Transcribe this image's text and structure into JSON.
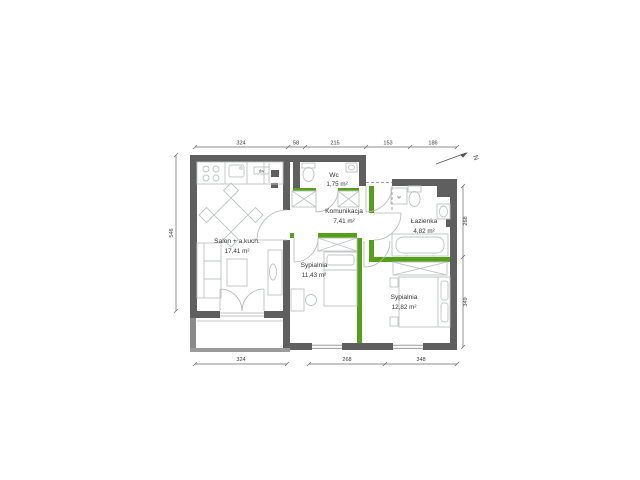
{
  "plan": {
    "north": {
      "label": "N"
    },
    "rooms": [
      {
        "name": "Salon + a.kuch.",
        "area": "17,41 m²"
      },
      {
        "name": "Komunikacja",
        "area": "7,41 m²"
      },
      {
        "name": "Wc",
        "area": "1,75 m²"
      },
      {
        "name": "Łazienka",
        "area": "4,82 m²"
      },
      {
        "name": "Sypialnia",
        "area": "11,43 m²"
      },
      {
        "name": "Sypialnia",
        "area": "12,82 m²"
      }
    ],
    "dimensions": {
      "top": [
        "324",
        "58",
        "215",
        "153",
        "186"
      ],
      "bottom": [
        "324",
        "268",
        "348"
      ],
      "left": [
        "546"
      ],
      "right": [
        "268",
        "349"
      ]
    },
    "fixtures": {
      "washer_label": "w",
      "meter_label": "dw"
    },
    "colors": {
      "wall": "#5f5f5f",
      "accent_green": "#55a019",
      "furniture_stroke": "#bfc4c4",
      "dim_line": "#666666"
    }
  }
}
